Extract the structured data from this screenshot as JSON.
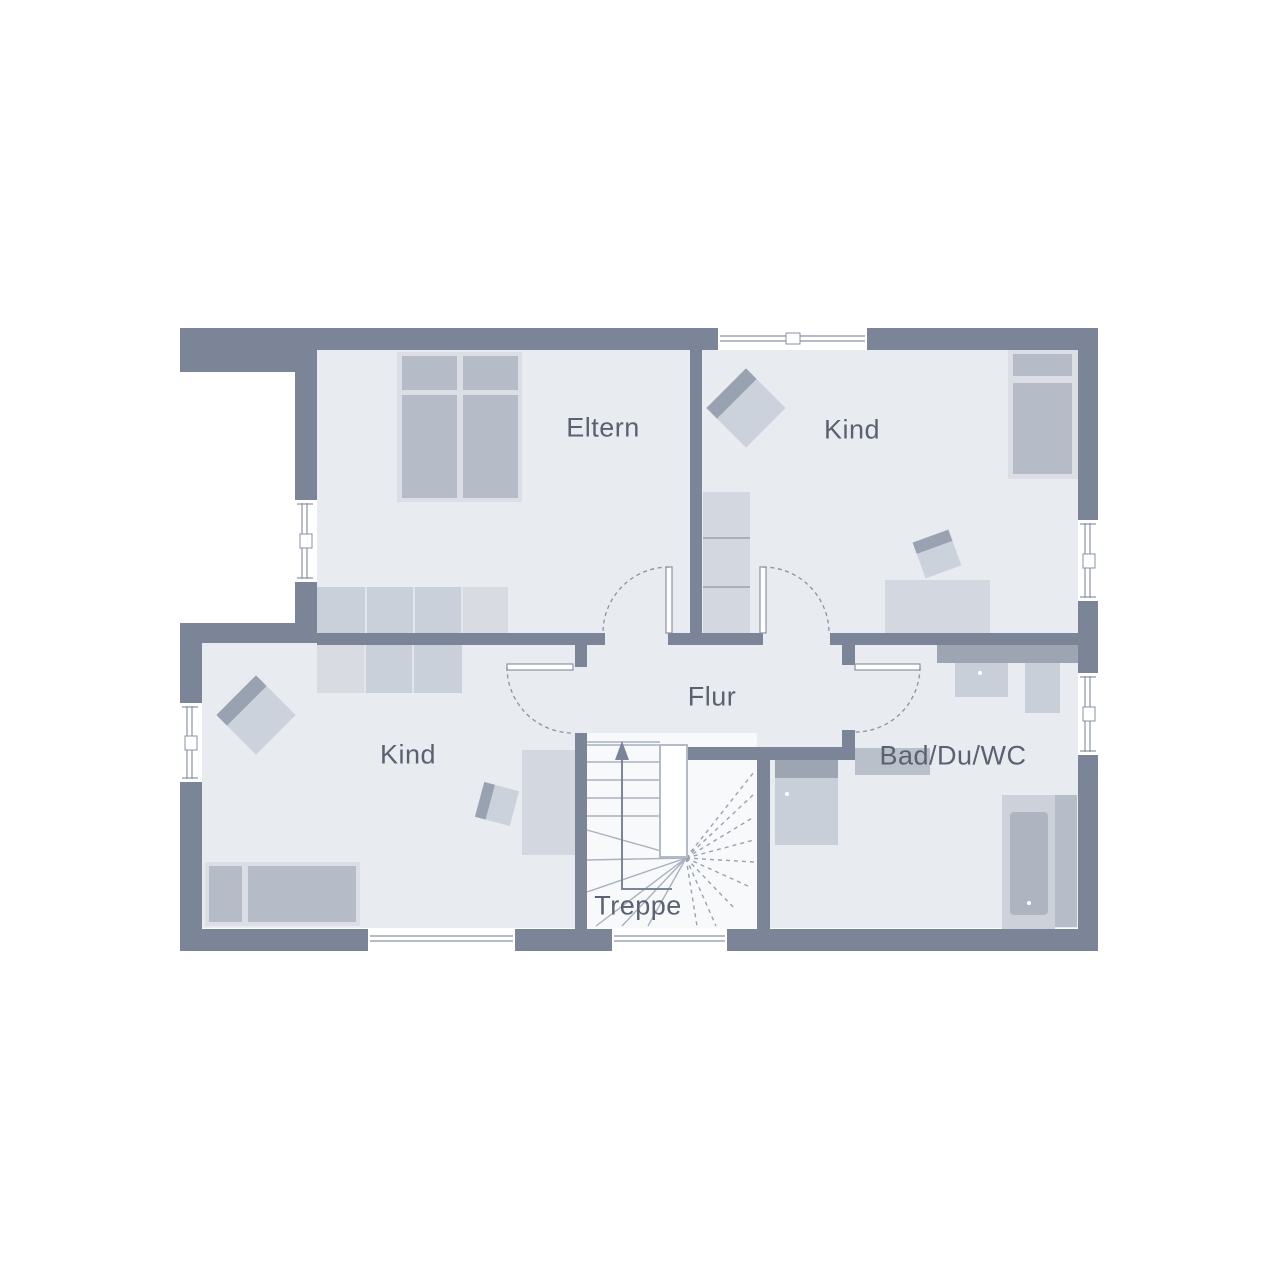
{
  "floorplan": {
    "type": "upper-floor residential floor plan",
    "rooms": [
      {
        "id": "eltern",
        "label": "Eltern"
      },
      {
        "id": "kind_top_right",
        "label": "Kind"
      },
      {
        "id": "kind_bottom_left",
        "label": "Kind"
      },
      {
        "id": "flur",
        "label": "Flur"
      },
      {
        "id": "bad",
        "label": "Bad/Du/WC"
      },
      {
        "id": "treppe",
        "label": "Treppe"
      }
    ],
    "inventory": [
      "double-bed",
      "wardrobe",
      "single-bed",
      "armchair",
      "desk",
      "desk-chair",
      "tall-cabinet",
      "washbasin-counter",
      "wc",
      "washing-machine",
      "bathtub",
      "winder-staircase",
      "up-arrow"
    ],
    "colors": {
      "wall": "#7b8597",
      "room_fill": "#e8ebf0",
      "stair_fill": "#f7f9fb",
      "furniture_light": "#d3d7df",
      "furniture_medium": "#b5bcc8",
      "furniture_dark": "#9da5b3",
      "bed_base": "#dbdee5",
      "wardrobe": "#cad0d9",
      "fixture": "#c9cfd8",
      "tub_inner": "#aeb5c1",
      "stair_line": "#aab1bd",
      "arc_line": "#8a93a3",
      "text": "#5a6170",
      "background": "#ffffff"
    }
  }
}
